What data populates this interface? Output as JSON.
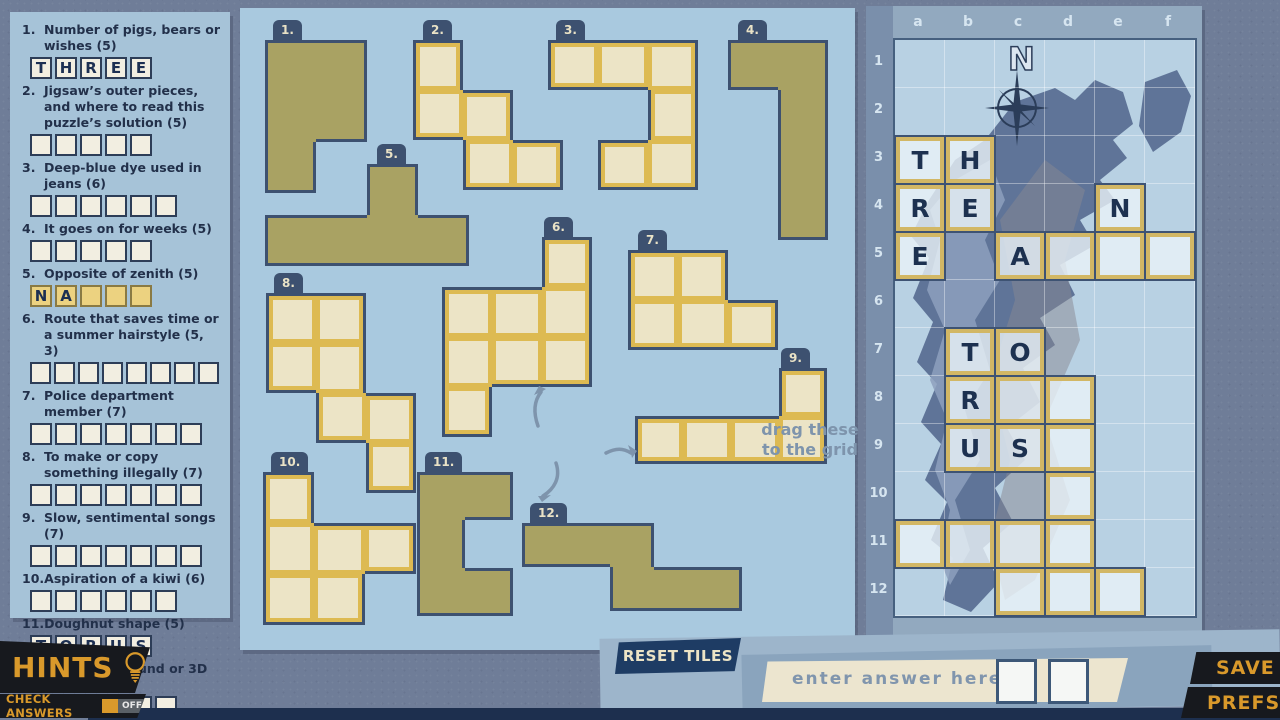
{
  "clues": {
    "items": [
      {
        "num": "1.",
        "text": "Number of pigs, bears or wishes (5)",
        "cells": [
          "T",
          "H",
          "R",
          "E",
          "E"
        ],
        "highlight": false
      },
      {
        "num": "2.",
        "text": "Jigsaw’s outer pieces, and where to read this puzzle’s solution (5)",
        "cells": [
          "",
          "",
          "",
          "",
          ""
        ],
        "highlight": false
      },
      {
        "num": "3.",
        "text": "Deep-blue dye used in jeans (6)",
        "cells": [
          "",
          "",
          "",
          "",
          "",
          ""
        ],
        "highlight": false
      },
      {
        "num": "4.",
        "text": "It goes on for weeks (5)",
        "cells": [
          "",
          "",
          "",
          "",
          ""
        ],
        "highlight": false
      },
      {
        "num": "5.",
        "text": "Opposite of zenith (5)",
        "cells": [
          "N",
          "A",
          "",
          "",
          ""
        ],
        "highlight": true
      },
      {
        "num": "6.",
        "text": "Route that saves time or a summer hairstyle (5, 3)",
        "cells": [
          "",
          "",
          "",
          "",
          "",
          "",
          "",
          ""
        ],
        "highlight": false
      },
      {
        "num": "7.",
        "text": "Police department member (7)",
        "cells": [
          "",
          "",
          "",
          "",
          "",
          "",
          ""
        ],
        "highlight": false
      },
      {
        "num": "8.",
        "text": "To make or copy something illegally (7)",
        "cells": [
          "",
          "",
          "",
          "",
          "",
          "",
          ""
        ],
        "highlight": false
      },
      {
        "num": "9.",
        "text": "Slow, sentimental songs (7)",
        "cells": [
          "",
          "",
          "",
          "",
          "",
          "",
          ""
        ],
        "highlight": false
      },
      {
        "num": "10.",
        "text": "Aspiration of a kiwi (6)",
        "cells": [
          "",
          "",
          "",
          "",
          "",
          ""
        ],
        "highlight": false
      },
      {
        "num": "11.",
        "text": "Doughnut shape (5)",
        "cells": [
          "T",
          "O",
          "R",
          "U",
          "S"
        ],
        "highlight": false
      },
      {
        "num": "12.",
        "text": "Amount of sound or 3D space (6)",
        "cells": [
          "",
          "",
          "",
          "",
          "",
          ""
        ],
        "highlight": false
      }
    ]
  },
  "tray": {
    "drag_hint_line1": "drag these",
    "drag_hint_line2": "to the grid",
    "pieces": [
      {
        "label": "1.",
        "state": "placed",
        "cell": 51,
        "x": 265,
        "y": 40,
        "tab_dx": 8,
        "rows": [
          "11",
          "11",
          "10"
        ]
      },
      {
        "label": "2.",
        "state": "available",
        "cell": 50,
        "x": 413,
        "y": 40,
        "tab_dx": 10,
        "rows": [
          "100",
          "110",
          "011"
        ]
      },
      {
        "label": "3.",
        "state": "available",
        "cell": 50,
        "x": 548,
        "y": 40,
        "tab_dx": 8,
        "rows": [
          "111",
          "001",
          "011"
        ]
      },
      {
        "label": "4.",
        "state": "placed",
        "cell": 50,
        "x": 728,
        "y": 40,
        "tab_dx": 10,
        "rows": [
          "11",
          "01",
          "01",
          "01"
        ]
      },
      {
        "label": "5.",
        "state": "placed",
        "cell": 51,
        "x": 265,
        "y": 164,
        "tab_dx": 112,
        "rows": [
          "0010",
          "1111"
        ]
      },
      {
        "label": "6.",
        "state": "available",
        "cell": 50,
        "x": 442,
        "y": 237,
        "tab_dx": 102,
        "rows": [
          "001",
          "111",
          "111",
          "100"
        ]
      },
      {
        "label": "7.",
        "state": "available",
        "cell": 50,
        "x": 628,
        "y": 250,
        "tab_dx": 10,
        "rows": [
          "110",
          "111"
        ]
      },
      {
        "label": "8.",
        "state": "available",
        "cell": 50,
        "x": 266,
        "y": 293,
        "tab_dx": 8,
        "rows": [
          "110",
          "110",
          "011",
          "001"
        ]
      },
      {
        "label": "9.",
        "state": "available",
        "cell": 48,
        "x": 635,
        "y": 368,
        "tab_dx": 146,
        "rows": [
          "0001",
          "1111"
        ]
      },
      {
        "label": "10.",
        "state": "available",
        "cell": 51,
        "x": 263,
        "y": 472,
        "tab_dx": 8,
        "rows": [
          "100",
          "111",
          "110"
        ]
      },
      {
        "label": "11.",
        "state": "placed",
        "cell": 48,
        "x": 417,
        "y": 472,
        "tab_dx": 8,
        "rows": [
          "11",
          "10",
          "11"
        ]
      },
      {
        "label": "12.",
        "state": "placed",
        "cell": 44,
        "x": 522,
        "y": 523,
        "tab_dx": 8,
        "rows": [
          "11100",
          "00111"
        ]
      }
    ]
  },
  "grid": {
    "col_labels": [
      "a",
      "b",
      "c",
      "d",
      "e",
      "f"
    ],
    "row_labels": [
      "1",
      "2",
      "3",
      "4",
      "5",
      "6",
      "7",
      "8",
      "9",
      "10",
      "11",
      "12"
    ],
    "compass_label": "N",
    "placed": [
      {
        "piece": "1",
        "tiles": [
          {
            "c": 0,
            "r": 2,
            "ch": "T"
          },
          {
            "c": 1,
            "r": 2,
            "ch": "H"
          },
          {
            "c": 0,
            "r": 3,
            "ch": "R"
          },
          {
            "c": 1,
            "r": 3,
            "ch": "E"
          },
          {
            "c": 0,
            "r": 4,
            "ch": "E"
          }
        ]
      },
      {
        "piece": "5",
        "tiles": [
          {
            "c": 4,
            "r": 3,
            "ch": "N"
          },
          {
            "c": 2,
            "r": 4,
            "ch": "A"
          },
          {
            "c": 3,
            "r": 4,
            "ch": ""
          },
          {
            "c": 4,
            "r": 4,
            "ch": ""
          },
          {
            "c": 5,
            "r": 4,
            "ch": ""
          }
        ]
      },
      {
        "piece": "11",
        "tiles": [
          {
            "c": 1,
            "r": 6,
            "ch": "T"
          },
          {
            "c": 2,
            "r": 6,
            "ch": "O"
          },
          {
            "c": 1,
            "r": 7,
            "ch": "R"
          },
          {
            "c": 1,
            "r": 8,
            "ch": "U"
          },
          {
            "c": 2,
            "r": 8,
            "ch": "S"
          }
        ]
      },
      {
        "piece": "4",
        "tiles": [
          {
            "c": 2,
            "r": 7,
            "ch": ""
          },
          {
            "c": 3,
            "r": 7,
            "ch": ""
          },
          {
            "c": 3,
            "r": 8,
            "ch": ""
          },
          {
            "c": 3,
            "r": 9,
            "ch": ""
          },
          {
            "c": 3,
            "r": 10,
            "ch": ""
          }
        ]
      },
      {
        "piece": "12",
        "tiles": [
          {
            "c": 0,
            "r": 10,
            "ch": ""
          },
          {
            "c": 1,
            "r": 10,
            "ch": ""
          },
          {
            "c": 2,
            "r": 10,
            "ch": ""
          },
          {
            "c": 2,
            "r": 11,
            "ch": ""
          },
          {
            "c": 3,
            "r": 11,
            "ch": ""
          },
          {
            "c": 4,
            "r": 11,
            "ch": ""
          }
        ]
      }
    ]
  },
  "footer": {
    "hints_label": "HINTS",
    "check_answers_label": "CHECK ANSWERS",
    "toggle_state": "OFF",
    "reset_label": "RESET TILES",
    "answer_prompt": "enter answer here:",
    "save_label": "SAVE",
    "prefs_label": "PREFS"
  },
  "colors": {
    "background": "#6f7d98",
    "panel_blue": "#a9c9df",
    "sea_blue": "#b8d1e3",
    "landmass": "#5f7498",
    "navy_outline": "#3d5170",
    "tile_gold": "#d2b765",
    "tray_gold": "#ddba52",
    "olive_placed": "#a9a263",
    "cream": "#ece4c6",
    "accent_gold_text": "#d9992b",
    "button_navy": "#1e3c64"
  }
}
